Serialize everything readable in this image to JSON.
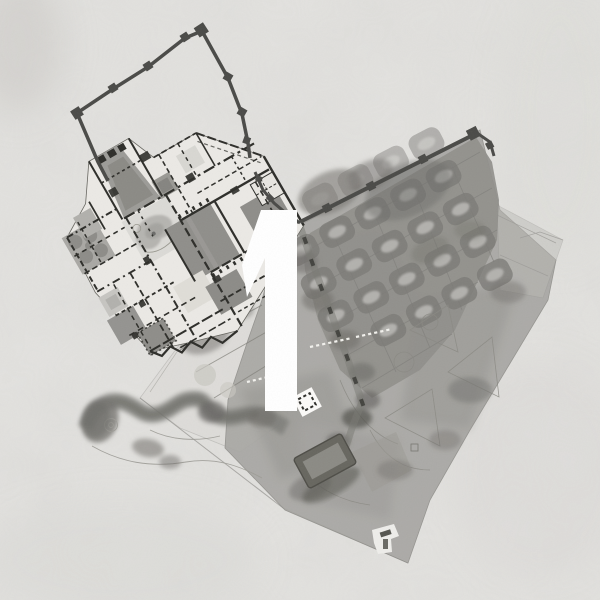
{
  "canvas": {
    "width": 600,
    "height": 600,
    "background_color": "#e3e2df"
  },
  "overlay": {
    "figure_label": "1",
    "label_color": "#ffffff"
  },
  "map": {
    "type": "architectural-site-plan",
    "style": "grayscale watercolor plan on textured paper",
    "palette": {
      "paper": "#e3e2df",
      "plan_floor": "#ebe9e5",
      "wall_ink": "#2d2d29",
      "rampart": "#4a4a47",
      "courtyard_gray": "#8f8e8a",
      "garden_mass": "#a6a5a1",
      "orchard_bed": "#7c7b77",
      "bed_highlight": "#b5b4b0",
      "tree_canopy": "#6d6c68",
      "pool_dark": "#67665f",
      "marker_white": "#fbfaf8"
    },
    "features": [
      {
        "name": "fortified-wall-enclosure",
        "description": "rampart with square towers enclosing an empty court, upper left"
      },
      {
        "name": "palace-complex",
        "description": "dense room plan with courtyards, tower and ponds, center left"
      },
      {
        "name": "walled-orchard-grid",
        "description": "terrace with grid of planting beds behind the long wall, upper right"
      },
      {
        "name": "informal-gardens",
        "description": "tree canopies, winding hedge and thin path outlines, lower half"
      },
      {
        "name": "reflecting-pool",
        "description": "dark rectangular basin, lower center"
      },
      {
        "name": "walk-marker",
        "description": "white square with dashed border on the main walk"
      },
      {
        "name": "lower-plaza",
        "description": "small white terrace with stair mark near the southern tip"
      }
    ]
  }
}
